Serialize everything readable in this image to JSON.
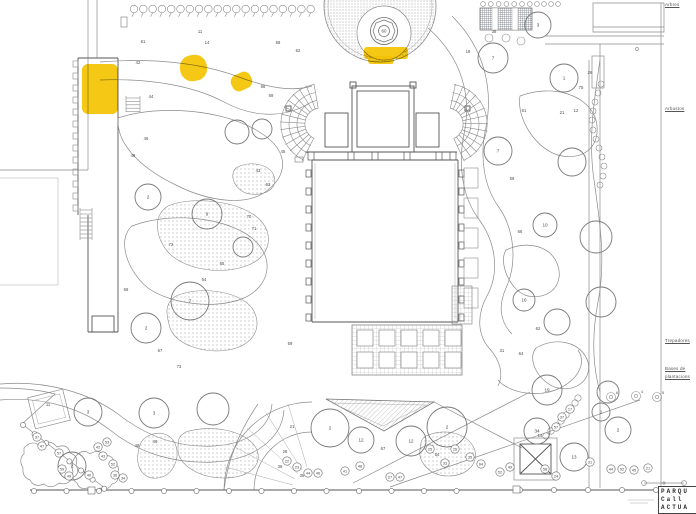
{
  "colors": {
    "highlight": "#F3C300",
    "line": "#8b8b8b",
    "dark_line": "#565656"
  },
  "legend": {
    "arbres": "Arbres",
    "arbustos": "Arbustos",
    "trepadores": "Trepadores",
    "plantacions_l1": "Bases de",
    "plantacions_l2": "plantacions"
  },
  "title_block": {
    "line1": "PARQU",
    "line2": "Call",
    "line3": "ACTUA"
  },
  "fountain": {
    "label": "60"
  },
  "highlights": [
    {
      "x": 82,
      "y": 64,
      "w": 36,
      "h": 50,
      "rx": 6,
      "rot": 0
    },
    {
      "x": 180,
      "y": 55,
      "w": 27,
      "h": 26,
      "rx": 12,
      "rot": -8
    },
    {
      "x": 231,
      "y": 73,
      "w": 21,
      "h": 17,
      "rx": 7,
      "rot": -25
    },
    {
      "x": 364,
      "y": 47,
      "w": 44,
      "h": 12,
      "rx": 3,
      "rot": 0
    },
    {
      "x": 368,
      "y": 56,
      "w": 26,
      "h": 8,
      "rx": 3,
      "rot": 0
    }
  ],
  "trees": [
    {
      "x": 148,
      "y": 197,
      "r": 13,
      "t": "2"
    },
    {
      "x": 207,
      "y": 214,
      "r": 15,
      "t": "9"
    },
    {
      "x": 190,
      "y": 301,
      "r": 19,
      "t": "7"
    },
    {
      "x": 146,
      "y": 328,
      "r": 15,
      "t": "2"
    },
    {
      "x": 237,
      "y": 132,
      "r": 12,
      "t": ""
    },
    {
      "x": 262,
      "y": 129,
      "r": 10,
      "t": ""
    },
    {
      "x": 243,
      "y": 247,
      "r": 10,
      "t": ""
    },
    {
      "x": 538,
      "y": 25,
      "r": 13,
      "t": "3"
    },
    {
      "x": 493,
      "y": 58,
      "r": 15,
      "t": "7"
    },
    {
      "x": 564,
      "y": 78,
      "r": 14,
      "t": "1"
    },
    {
      "x": 498,
      "y": 151,
      "r": 14,
      "t": "7"
    },
    {
      "x": 572,
      "y": 162,
      "r": 14,
      "t": ""
    },
    {
      "x": 545,
      "y": 225,
      "r": 12,
      "t": "10"
    },
    {
      "x": 596,
      "y": 237,
      "r": 16,
      "t": ""
    },
    {
      "x": 524,
      "y": 300,
      "r": 11,
      "t": "16"
    },
    {
      "x": 557,
      "y": 322,
      "r": 13,
      "t": ""
    },
    {
      "x": 601,
      "y": 302,
      "r": 15,
      "t": ""
    },
    {
      "x": 547,
      "y": 390,
      "r": 15,
      "t": "19"
    },
    {
      "x": 608,
      "y": 392,
      "r": 11,
      "t": ""
    },
    {
      "x": 88,
      "y": 412,
      "r": 14,
      "t": "3"
    },
    {
      "x": 154,
      "y": 413,
      "r": 15,
      "t": "3"
    },
    {
      "x": 213,
      "y": 409,
      "r": 16,
      "t": ""
    },
    {
      "x": 72,
      "y": 466,
      "r": 14,
      "t": "2"
    },
    {
      "x": 330,
      "y": 428,
      "r": 19,
      "t": "2"
    },
    {
      "x": 361,
      "y": 440,
      "r": 13,
      "t": "12"
    },
    {
      "x": 411,
      "y": 441,
      "r": 15,
      "t": "12"
    },
    {
      "x": 447,
      "y": 427,
      "r": 20,
      "t": "2"
    },
    {
      "x": 537,
      "y": 431,
      "r": 13,
      "t": "34"
    },
    {
      "x": 574,
      "y": 457,
      "r": 14,
      "t": "13"
    },
    {
      "x": 601,
      "y": 412,
      "r": 9,
      "t": "1"
    },
    {
      "x": 618,
      "y": 430,
      "r": 13,
      "t": "2"
    }
  ],
  "shrubs": [
    {
      "x": 611,
      "y": 397,
      "t": "6"
    },
    {
      "x": 636,
      "y": 396,
      "t": "4"
    },
    {
      "x": 657,
      "y": 397,
      "t": "5"
    }
  ],
  "labels": [
    {
      "t": "61",
      "x": 143,
      "y": 43
    },
    {
      "t": "42",
      "x": 138,
      "y": 64
    },
    {
      "t": "11",
      "x": 200,
      "y": 33
    },
    {
      "t": "14",
      "x": 207,
      "y": 44
    },
    {
      "t": "58",
      "x": 278,
      "y": 44
    },
    {
      "t": "62",
      "x": 298,
      "y": 52
    },
    {
      "t": "44",
      "x": 151,
      "y": 98
    },
    {
      "t": "46",
      "x": 146,
      "y": 140
    },
    {
      "t": "48",
      "x": 133,
      "y": 157
    },
    {
      "t": "68",
      "x": 263,
      "y": 88
    },
    {
      "t": "69",
      "x": 271,
      "y": 97
    },
    {
      "t": "43",
      "x": 258,
      "y": 172
    },
    {
      "t": "45",
      "x": 283,
      "y": 153
    },
    {
      "t": "63",
      "x": 268,
      "y": 186
    },
    {
      "t": "70",
      "x": 249,
      "y": 218
    },
    {
      "t": "71",
      "x": 254,
      "y": 230
    },
    {
      "t": "65",
      "x": 222,
      "y": 265
    },
    {
      "t": "64",
      "x": 204,
      "y": 281
    },
    {
      "t": "72",
      "x": 171,
      "y": 246
    },
    {
      "t": "66",
      "x": 126,
      "y": 291
    },
    {
      "t": "67",
      "x": 160,
      "y": 352
    },
    {
      "t": "73",
      "x": 179,
      "y": 368
    },
    {
      "t": "59",
      "x": 290,
      "y": 345
    },
    {
      "t": "38",
      "x": 494,
      "y": 33
    },
    {
      "t": "18",
      "x": 468,
      "y": 53
    },
    {
      "t": "26",
      "x": 590,
      "y": 74
    },
    {
      "t": "75",
      "x": 581,
      "y": 89
    },
    {
      "t": "61",
      "x": 524,
      "y": 112
    },
    {
      "t": "21",
      "x": 562,
      "y": 114
    },
    {
      "t": "12",
      "x": 576,
      "y": 112
    },
    {
      "t": "59",
      "x": 512,
      "y": 180
    },
    {
      "t": "66",
      "x": 520,
      "y": 233
    },
    {
      "t": "62",
      "x": 538,
      "y": 330
    },
    {
      "t": "31",
      "x": 502,
      "y": 352
    },
    {
      "t": "64",
      "x": 521,
      "y": 355
    },
    {
      "t": "21",
      "x": 292,
      "y": 428
    },
    {
      "t": "28",
      "x": 285,
      "y": 453
    },
    {
      "t": "36",
      "x": 280,
      "y": 468
    },
    {
      "t": "35",
      "x": 302,
      "y": 477
    },
    {
      "t": "67",
      "x": 383,
      "y": 450
    },
    {
      "t": "54",
      "x": 437,
      "y": 456
    },
    {
      "t": "48",
      "x": 137,
      "y": 447
    },
    {
      "t": "46",
      "x": 155,
      "y": 443
    },
    {
      "t": "11",
      "x": 48,
      "y": 406
    },
    {
      "t": "14",
      "x": 540,
      "y": 437
    }
  ],
  "circled": [
    {
      "t": "37",
      "x": 37,
      "y": 437
    },
    {
      "t": "47",
      "x": 42,
      "y": 446
    },
    {
      "t": "57",
      "x": 59,
      "y": 453
    },
    {
      "t": "53",
      "x": 107,
      "y": 442
    },
    {
      "t": "42",
      "x": 98,
      "y": 447
    },
    {
      "t": "43",
      "x": 103,
      "y": 456
    },
    {
      "t": "52",
      "x": 113,
      "y": 464
    },
    {
      "t": "59",
      "x": 62,
      "y": 469
    },
    {
      "t": "49",
      "x": 69,
      "y": 476
    },
    {
      "t": "40",
      "x": 89,
      "y": 475
    },
    {
      "t": "36",
      "x": 115,
      "y": 475
    },
    {
      "t": "34",
      "x": 123,
      "y": 478
    },
    {
      "t": "22",
      "x": 287,
      "y": 461
    },
    {
      "t": "23",
      "x": 297,
      "y": 467
    },
    {
      "t": "44",
      "x": 308,
      "y": 473
    },
    {
      "t": "46",
      "x": 318,
      "y": 473
    },
    {
      "t": "41",
      "x": 345,
      "y": 471
    },
    {
      "t": "48",
      "x": 360,
      "y": 466
    },
    {
      "t": "27",
      "x": 390,
      "y": 477
    },
    {
      "t": "47",
      "x": 400,
      "y": 477
    },
    {
      "t": "25",
      "x": 430,
      "y": 449
    },
    {
      "t": "33",
      "x": 445,
      "y": 463
    },
    {
      "t": "26",
      "x": 455,
      "y": 449
    },
    {
      "t": "35",
      "x": 470,
      "y": 457
    },
    {
      "t": "64",
      "x": 481,
      "y": 464
    },
    {
      "t": "52",
      "x": 500,
      "y": 472
    },
    {
      "t": "49",
      "x": 510,
      "y": 467
    },
    {
      "t": "58",
      "x": 545,
      "y": 469
    },
    {
      "t": "24",
      "x": 556,
      "y": 476
    },
    {
      "t": "31",
      "x": 590,
      "y": 462
    },
    {
      "t": "44",
      "x": 611,
      "y": 469
    },
    {
      "t": "52",
      "x": 622,
      "y": 469
    },
    {
      "t": "45",
      "x": 634,
      "y": 470
    },
    {
      "t": "21",
      "x": 648,
      "y": 468
    },
    {
      "t": "37",
      "x": 562,
      "y": 417
    },
    {
      "t": "57",
      "x": 556,
      "y": 427
    },
    {
      "t": "17",
      "x": 570,
      "y": 409
    }
  ]
}
